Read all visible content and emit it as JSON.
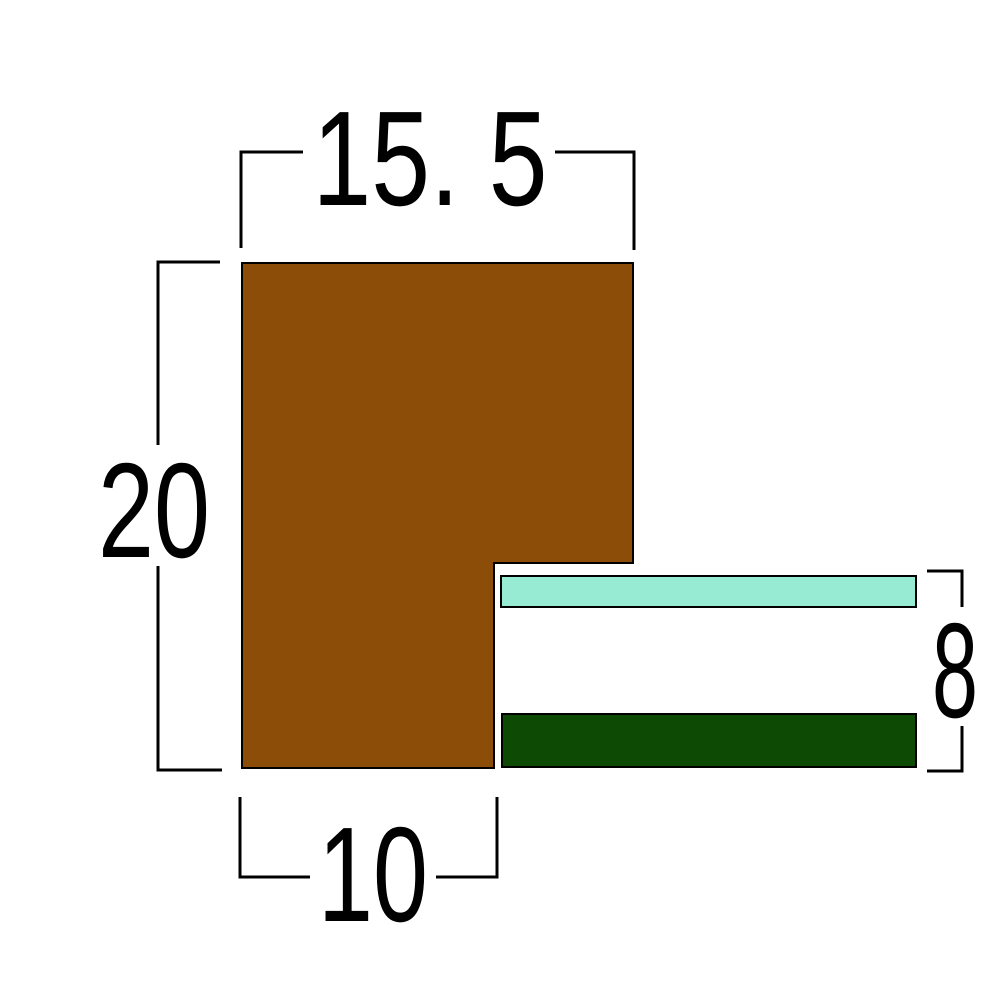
{
  "diagram": {
    "kind": "moulding-cross-section",
    "labels": {
      "top_width": "15. 5",
      "left_height": "20",
      "bottom_width": "10",
      "right_height": "8"
    },
    "colors": {
      "background": "#ffffff",
      "moulding_fill": "#8B4D08",
      "lip_fill": "#97EBD3",
      "base_fill": "#0D4A04",
      "outline": "#000000",
      "dimension_line": "#000000",
      "label_text": "#000000",
      "label_mask": "#ffffff"
    }
  }
}
